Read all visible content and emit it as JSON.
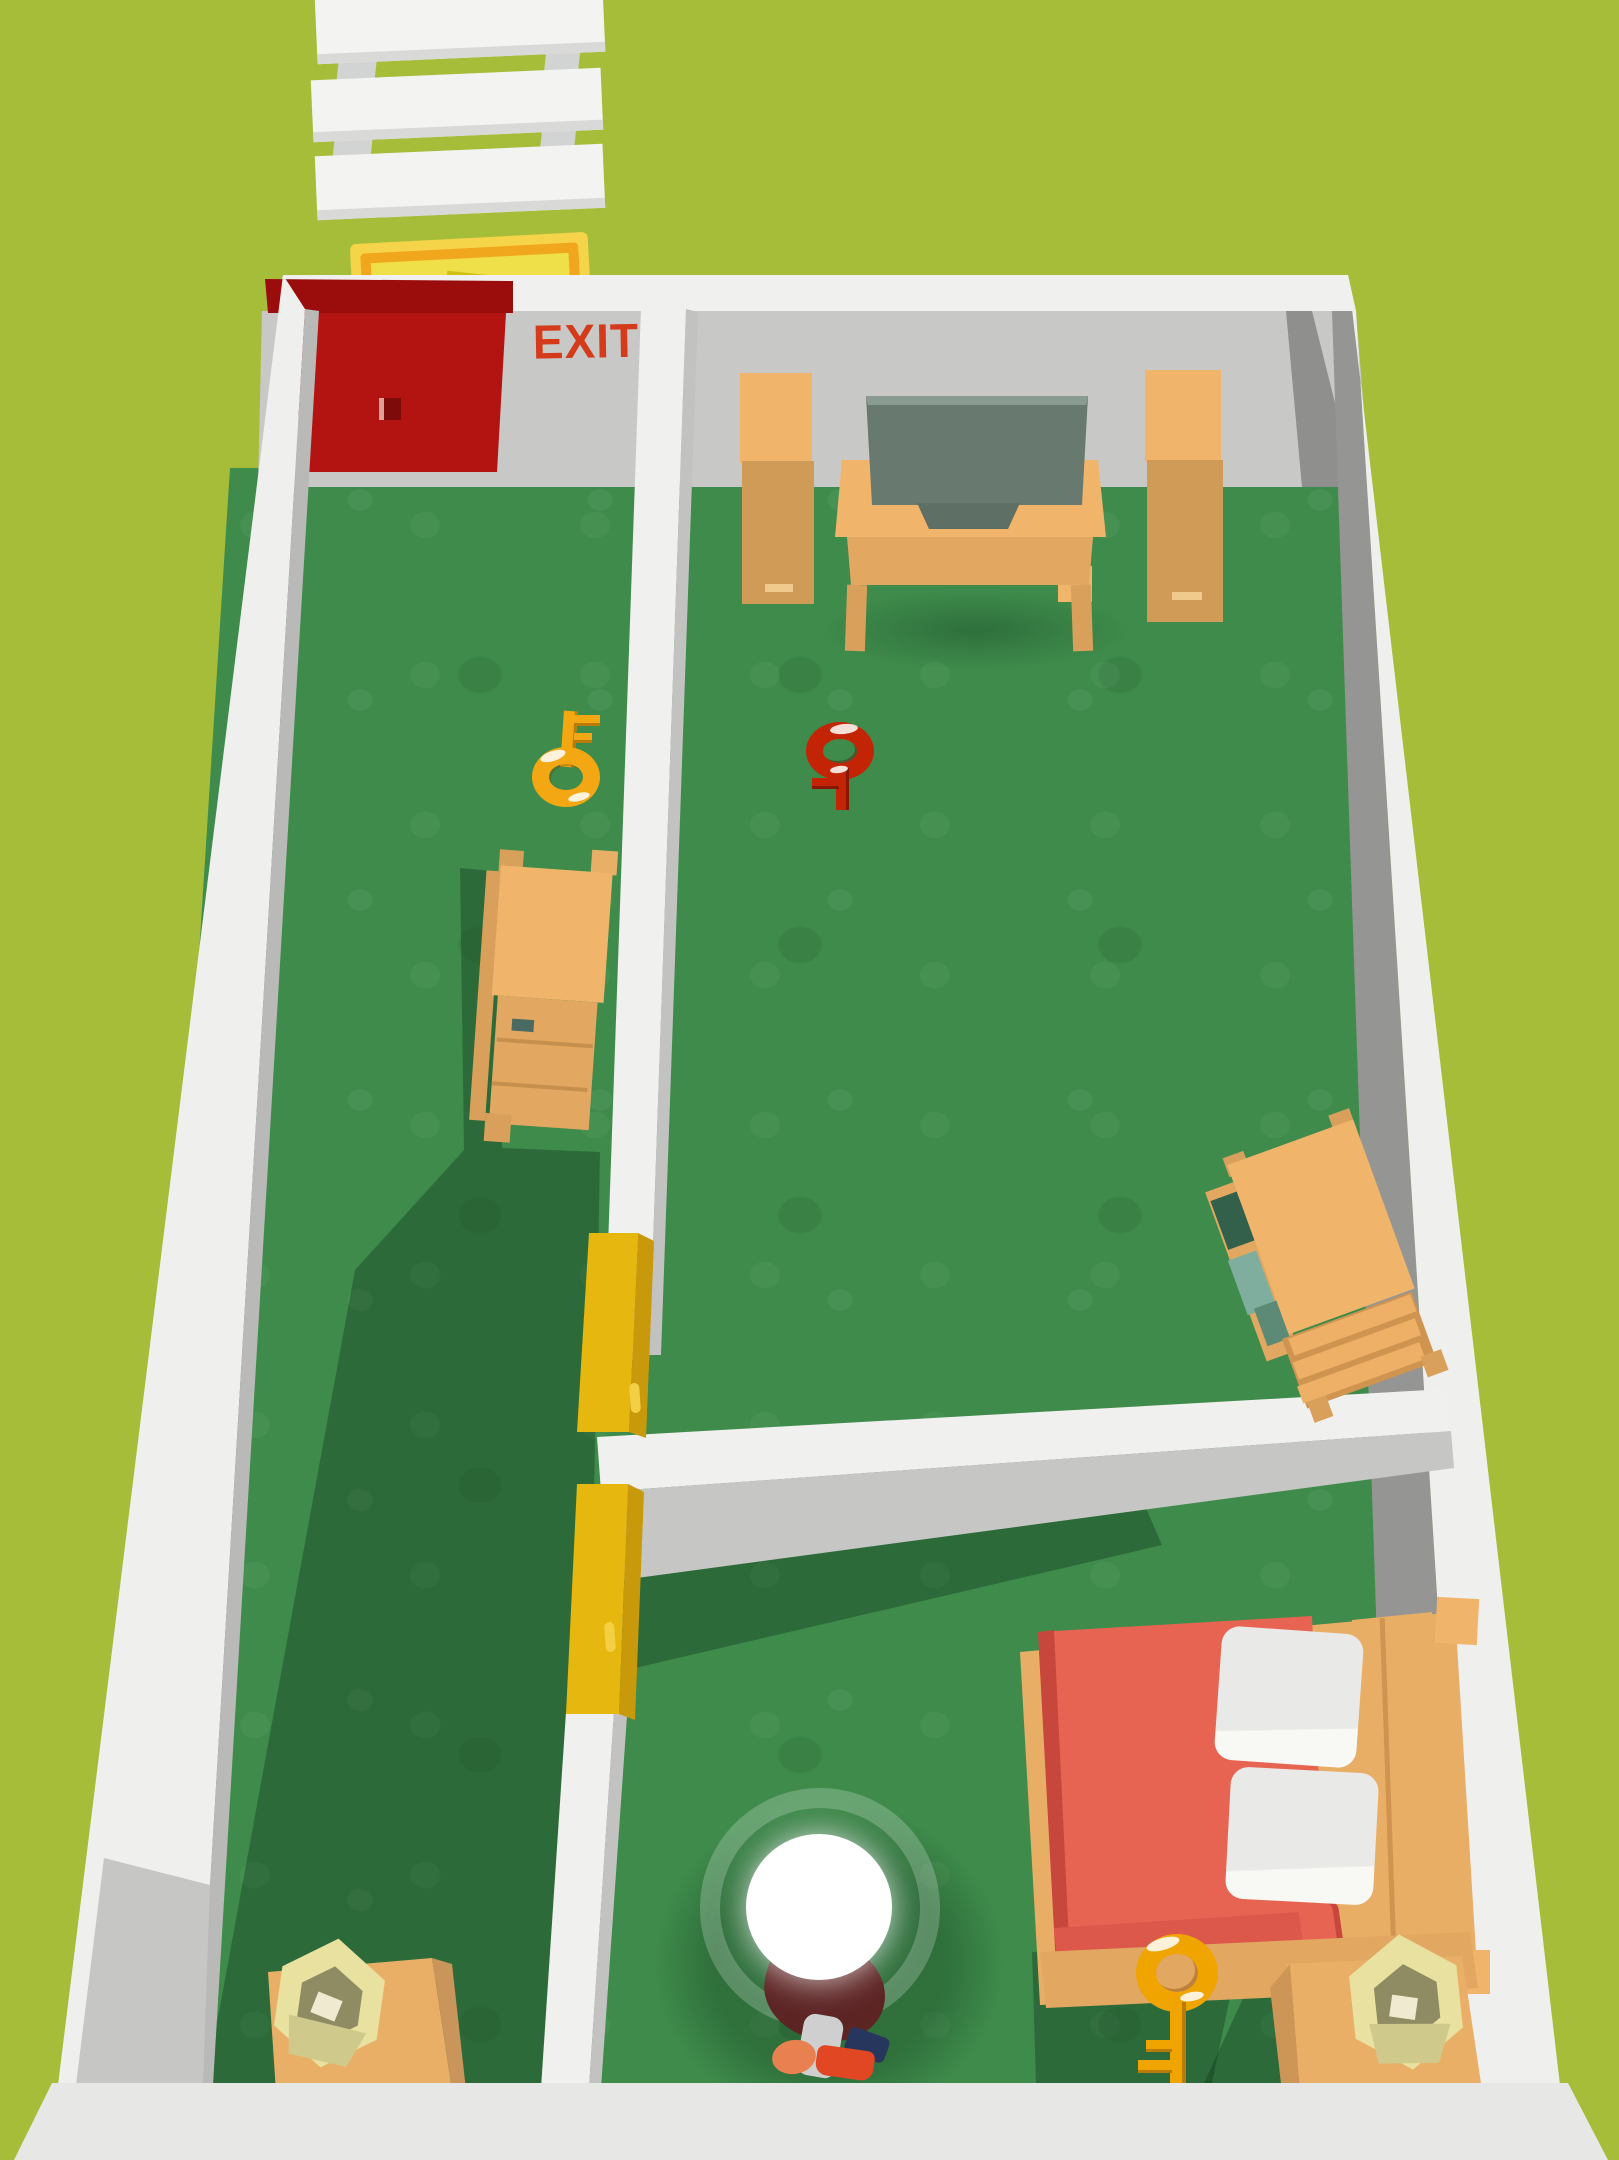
{
  "scene": {
    "description": "top-down room escape puzzle level",
    "exit_sign": {
      "label": "EXIT",
      "color": "#d43b1b"
    },
    "colors": {
      "outside_background": "#a6bd39",
      "floor_green": "#3e8b4b",
      "floor_shadow": "#2c6e3c",
      "wall_white": "#f0f0ee",
      "wall_inner_gray": "#c8c8c7",
      "wall_inner_dark": "#969695",
      "wall_bottom": "#e7e7e5",
      "exit_door_red": "#b31311",
      "exit_door_top": "#9a0d0c",
      "locked_door_yellow": "#e6b70e",
      "locked_door_yellow_dark": "#c8990b",
      "wood_light": "#f0b56b",
      "wood_mid": "#e2a760",
      "wood_dark": "#d09a57",
      "tv_screen": "#68796f",
      "key_gold": "#f2a713",
      "key_red": "#c42406",
      "bed_blanket": "#e86452",
      "pillow_white": "#ededeb",
      "lamp_shade": "#e8e19f",
      "sign_outer": "#f6d44a",
      "sign_frame": "#f0a61d",
      "sign_inner": "#efdf48",
      "character_shirt": "#5d2424",
      "spotlight": "#ffffff"
    },
    "objects": [
      {
        "name": "plank-path",
        "type": "walkway",
        "color": "#f3f3f1"
      },
      {
        "name": "wall-sign",
        "type": "decor",
        "color": "#f6d44a"
      },
      {
        "name": "exit-door",
        "type": "door",
        "color": "#b31311"
      },
      {
        "name": "yellow-door-upper",
        "type": "locked-door",
        "color": "#e6b70e"
      },
      {
        "name": "yellow-door-lower",
        "type": "locked-door",
        "color": "#e6b70e"
      },
      {
        "name": "key-gold-left-room",
        "type": "key",
        "color": "#f2a713"
      },
      {
        "name": "key-red-living-room",
        "type": "key",
        "color": "#c42406"
      },
      {
        "name": "key-gold-bedroom",
        "type": "key",
        "color": "#f0a400"
      },
      {
        "name": "tv",
        "type": "furniture",
        "color": "#68796f"
      },
      {
        "name": "tv-stand",
        "type": "furniture",
        "color": "#f0b56b"
      },
      {
        "name": "speaker-left",
        "type": "furniture",
        "color": "#f0b56b"
      },
      {
        "name": "speaker-right",
        "type": "furniture",
        "color": "#f0b56b"
      },
      {
        "name": "dresser",
        "type": "furniture",
        "color": "#f0b56b"
      },
      {
        "name": "bookshelf",
        "type": "furniture",
        "color": "#f0b56b"
      },
      {
        "name": "bed",
        "type": "furniture",
        "blanket_color": "#e86452"
      },
      {
        "name": "nightstand-left",
        "type": "furniture",
        "color": "#eaaf67"
      },
      {
        "name": "nightstand-right",
        "type": "furniture",
        "color": "#eaaf67"
      },
      {
        "name": "lamp-left",
        "type": "decor",
        "color": "#e8e19f"
      },
      {
        "name": "lamp-right",
        "type": "decor",
        "color": "#e8e19f"
      },
      {
        "name": "player-character",
        "type": "player",
        "shirt_color": "#5d2424"
      }
    ]
  }
}
